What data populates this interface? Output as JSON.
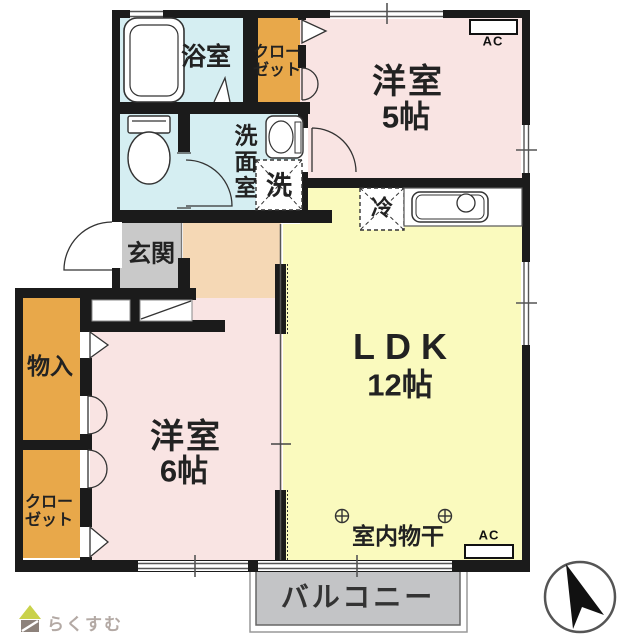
{
  "plan_title": "2LDK apartment floor plan",
  "rooms": {
    "bath": {
      "label": "浴室"
    },
    "closet_top": {
      "label": "クローゼット"
    },
    "western_room_5": {
      "name": "洋室",
      "size": "5帖"
    },
    "washroom": {
      "label": "洗面室"
    },
    "washer_space": {
      "label": "洗"
    },
    "entrance": {
      "label": "玄関"
    },
    "storage": {
      "label": "物入"
    },
    "closet_bottom": {
      "label": "クローゼット"
    },
    "western_room_6": {
      "name": "洋室",
      "size": "6帖"
    },
    "ldk": {
      "name": "LDK",
      "size": "12帖"
    },
    "fridge_space": {
      "label": "冷"
    },
    "indoor_drying": {
      "label": "室内物干"
    },
    "balcony": {
      "label": "バルコニー"
    }
  },
  "annotations": {
    "ac_top": "AC",
    "ac_bottom": "AC"
  },
  "branding": {
    "logo_text": "らくすむ"
  },
  "icons": {
    "bathtub": "bathtub-icon",
    "toilet": "toilet-icon",
    "washbasin": "washbasin-icon",
    "kitchen_sink": "kitchen-sink-icon",
    "compass": "compass-north-icon",
    "house_logo": "house-logo-icon",
    "laundry_pole": "laundry-pole-symbol"
  },
  "colors": {
    "wall": "#1b1b1b",
    "bath_blue": "#d5eef2",
    "room_pink": "#f9e4e3",
    "ldk_yellow": "#fafabe",
    "closet_orange": "#e8a84a",
    "hall_peach": "#f5d8b5",
    "entrance_gray": "#c9c9c9",
    "balcony_gray": "#c3c4c6",
    "logo_green": "#c9d24b",
    "logo_gray": "#8d827b"
  }
}
